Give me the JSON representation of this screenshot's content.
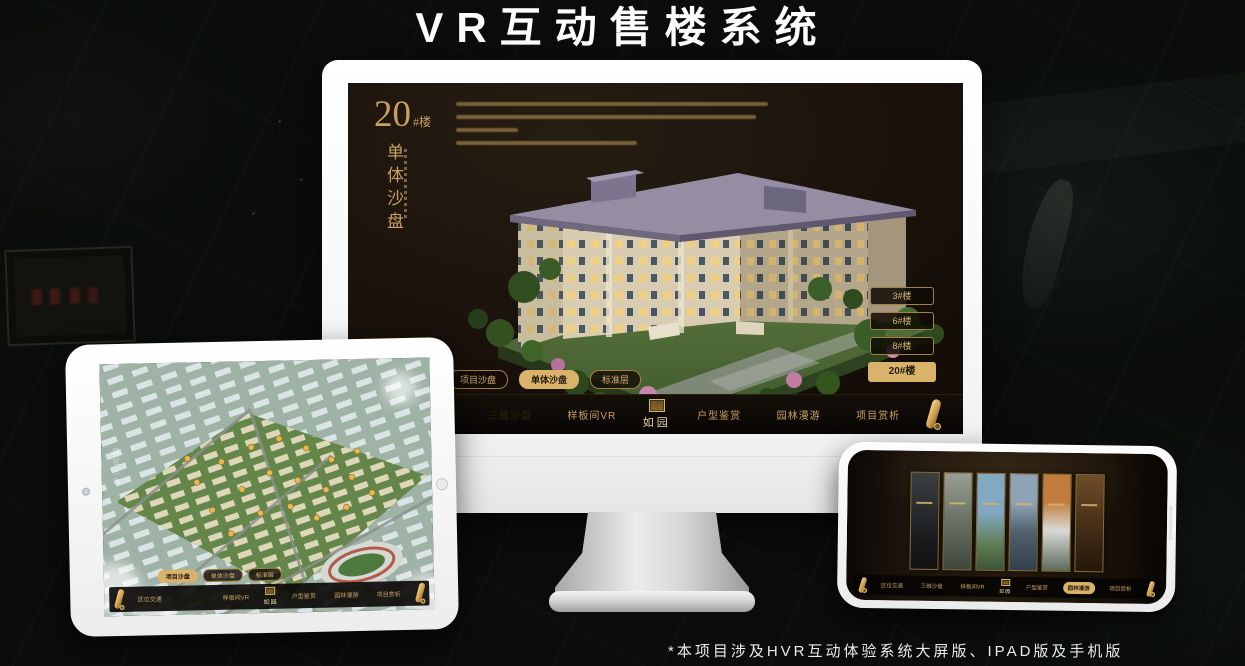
{
  "page": {
    "title": "VR互动售楼系统",
    "footnote": "*本项目涉及HVR互动体验系统大屏版、IPAD版及手机版"
  },
  "colors": {
    "gold": "#c9a063",
    "gold_active": "#d9b36a",
    "screen_dark": "#170f09"
  },
  "desktop": {
    "panel": {
      "building_number": "20",
      "building_suffix": "#楼",
      "vertical_title": "单体沙盘"
    },
    "floor_buttons": [
      {
        "label": "3#楼"
      },
      {
        "label": "6#楼"
      },
      {
        "label": "8#楼"
      },
      {
        "label": "20#楼"
      }
    ],
    "subtabs": [
      {
        "label": "项目沙盘"
      },
      {
        "label": "单体沙盘"
      },
      {
        "label": "标准层"
      }
    ],
    "nav": {
      "items": [
        "区位交通",
        "三维沙盘",
        "样板间VR",
        "户型鉴赏",
        "园林漫游",
        "项目赏析"
      ],
      "logo": "如园"
    }
  },
  "tablet": {
    "road_label": "园区三路",
    "subtabs": [
      {
        "label": "项目沙盘"
      },
      {
        "label": "单体沙盘"
      },
      {
        "label": "标准层"
      }
    ],
    "nav": {
      "items": [
        "区位交通",
        "三维沙盘",
        "样板间VR",
        "户型鉴赏",
        "园林漫游",
        "项目赏析"
      ],
      "logo": "如园"
    }
  },
  "phone": {
    "nav": {
      "items": [
        "区位交通",
        "三维沙盘",
        "样板间VR",
        "户型鉴赏",
        "园林漫游",
        "项目赏析"
      ],
      "logo": "如园"
    }
  }
}
